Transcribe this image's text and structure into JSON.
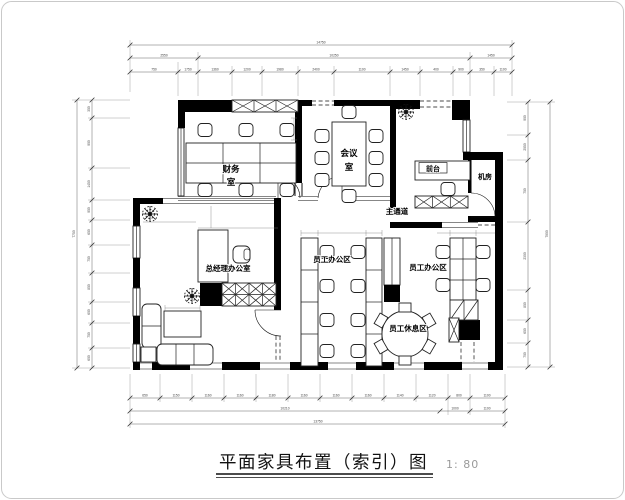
{
  "title_block": {
    "title": "平面家具布置（索引）图",
    "scale": "1: 80"
  },
  "rooms": {
    "finance": {
      "line1": "财务",
      "line2": "室"
    },
    "meeting": {
      "line1": "会议",
      "line2": "室"
    },
    "reception": "前台",
    "machine_room": "机房",
    "main_corridor": "主通道",
    "gm_office": "总经理办公室",
    "staff_office_1": "员工办公区",
    "staff_office_2": "员工办公区",
    "staff_rest": "员工休息区"
  },
  "dims": {
    "top_chain": [
      "750",
      "1750",
      "1360",
      "1200",
      "1980",
      "2400",
      "1100",
      "1450",
      "400",
      "900",
      "350",
      "1100"
    ],
    "top_mid": [
      "2550",
      "10250",
      "1450"
    ],
    "top_total": "14750",
    "bottom_chain": [
      "650",
      "1150",
      "1160",
      "1160",
      "1180",
      "1160",
      "1160",
      "1160",
      "1140",
      "1120",
      "800",
      "1100"
    ],
    "bottom_mid": [
      "10210",
      "1000",
      "1100"
    ],
    "bottom_total": "13750",
    "left_chain": [
      "350",
      "900",
      "1450",
      "950",
      "650",
      "750",
      "850",
      "600",
      "750",
      "600"
    ],
    "left_total": "7750",
    "right_chain": [
      "900",
      "2050",
      "750",
      "2300",
      "850",
      "650",
      "700"
    ],
    "right_total": "7900"
  }
}
